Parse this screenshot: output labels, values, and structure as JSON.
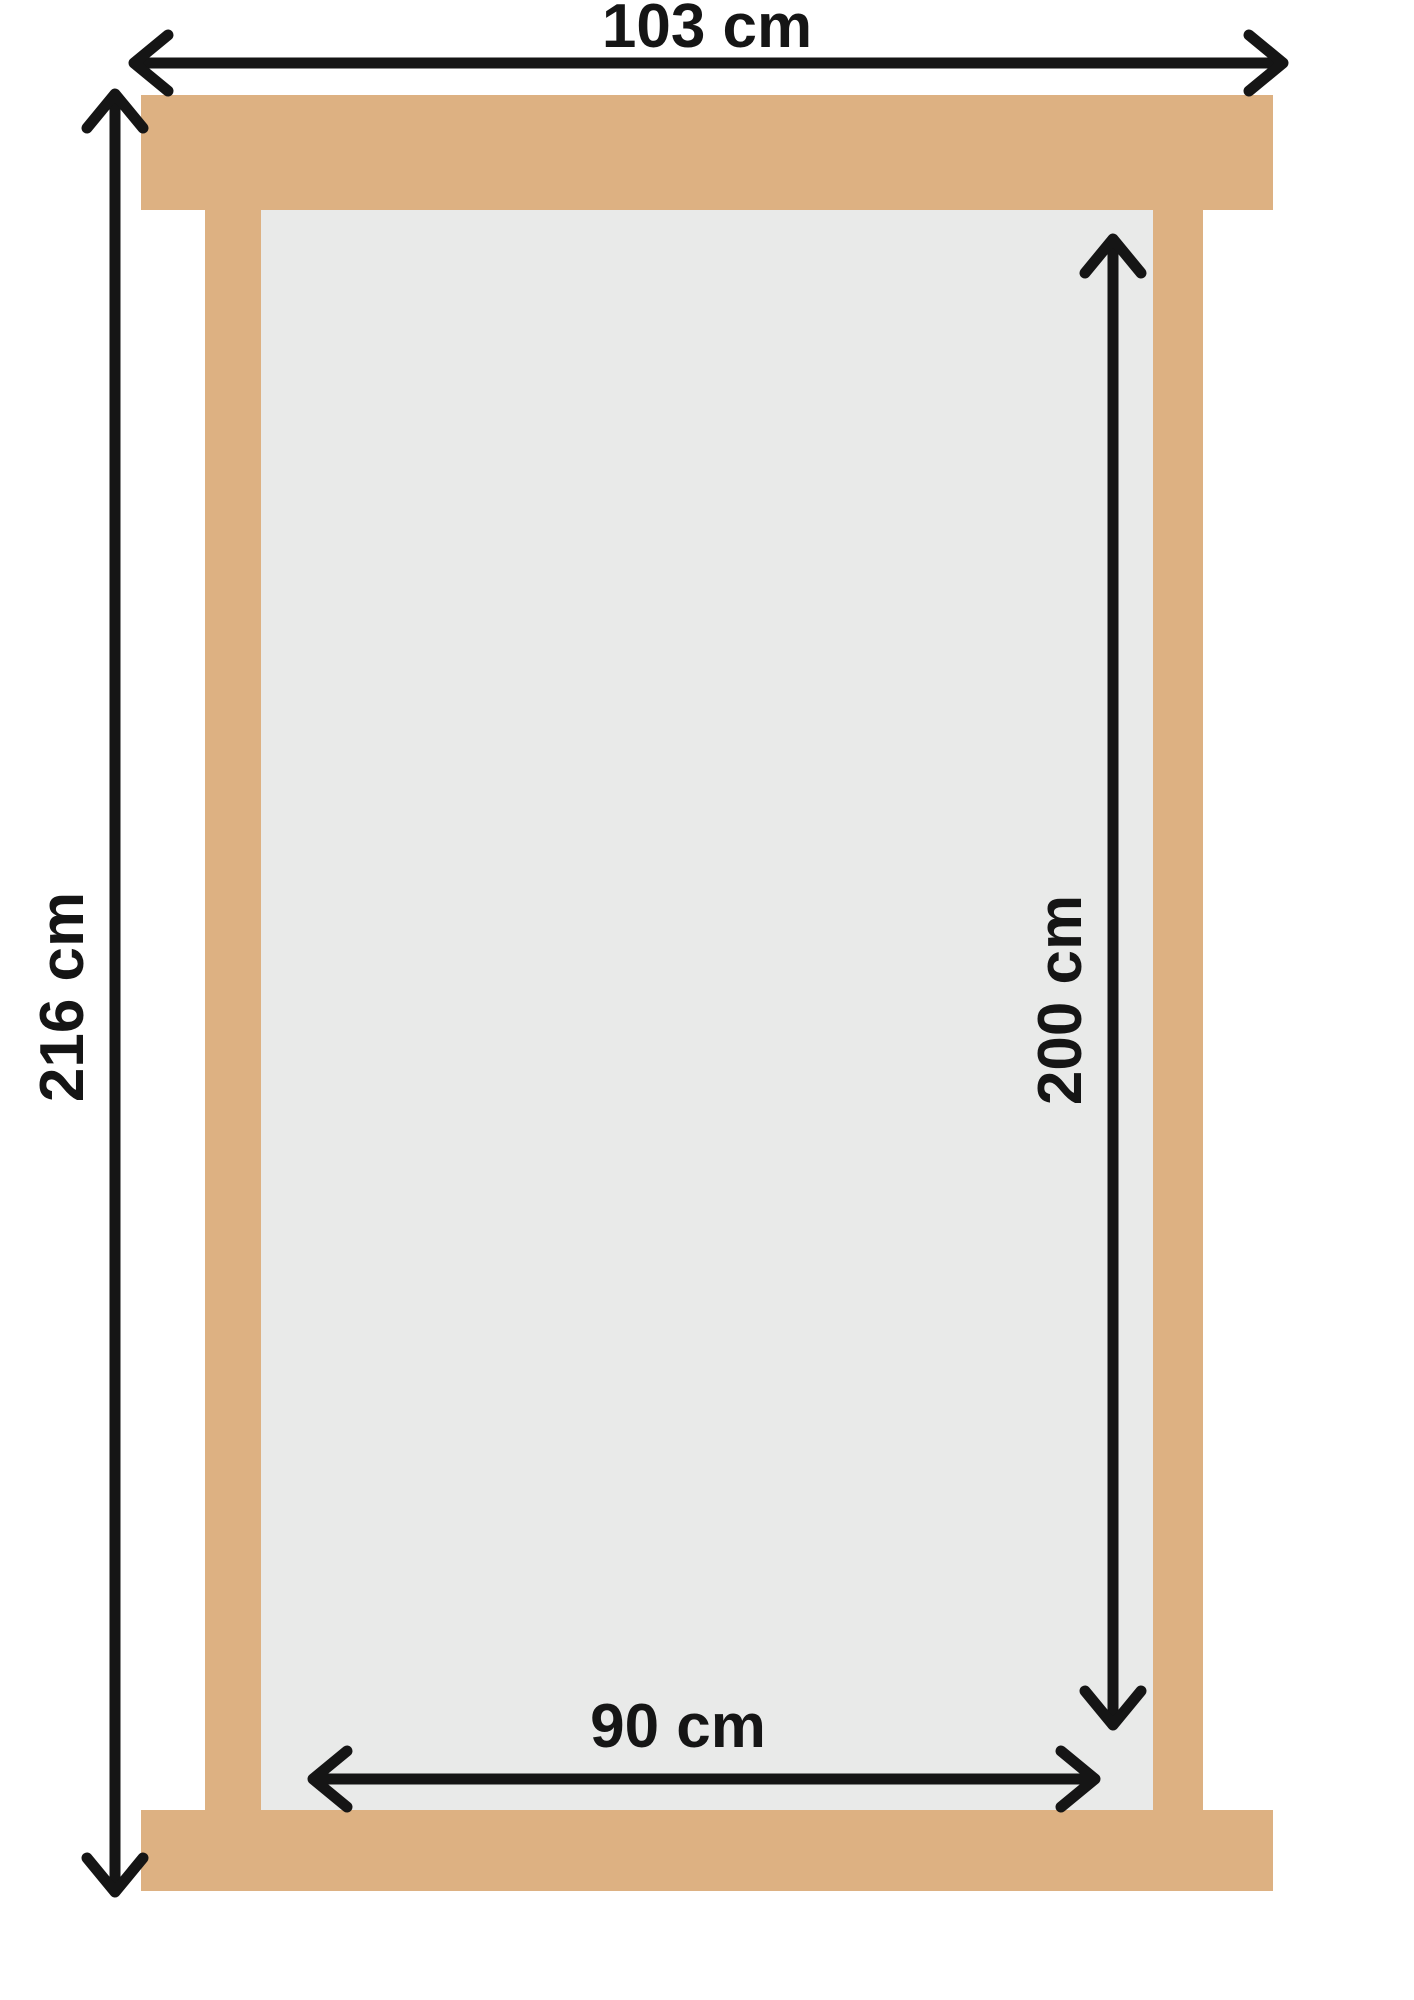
{
  "diagram": {
    "labels": {
      "outer_width": "103 cm",
      "outer_height": "216 cm",
      "inner_height": "200 cm",
      "inner_width": "90 cm"
    },
    "colors": {
      "frame": "#ddb182",
      "opening": "#e9eae9",
      "annotation": "#151515",
      "background": "#ffffff"
    }
  }
}
